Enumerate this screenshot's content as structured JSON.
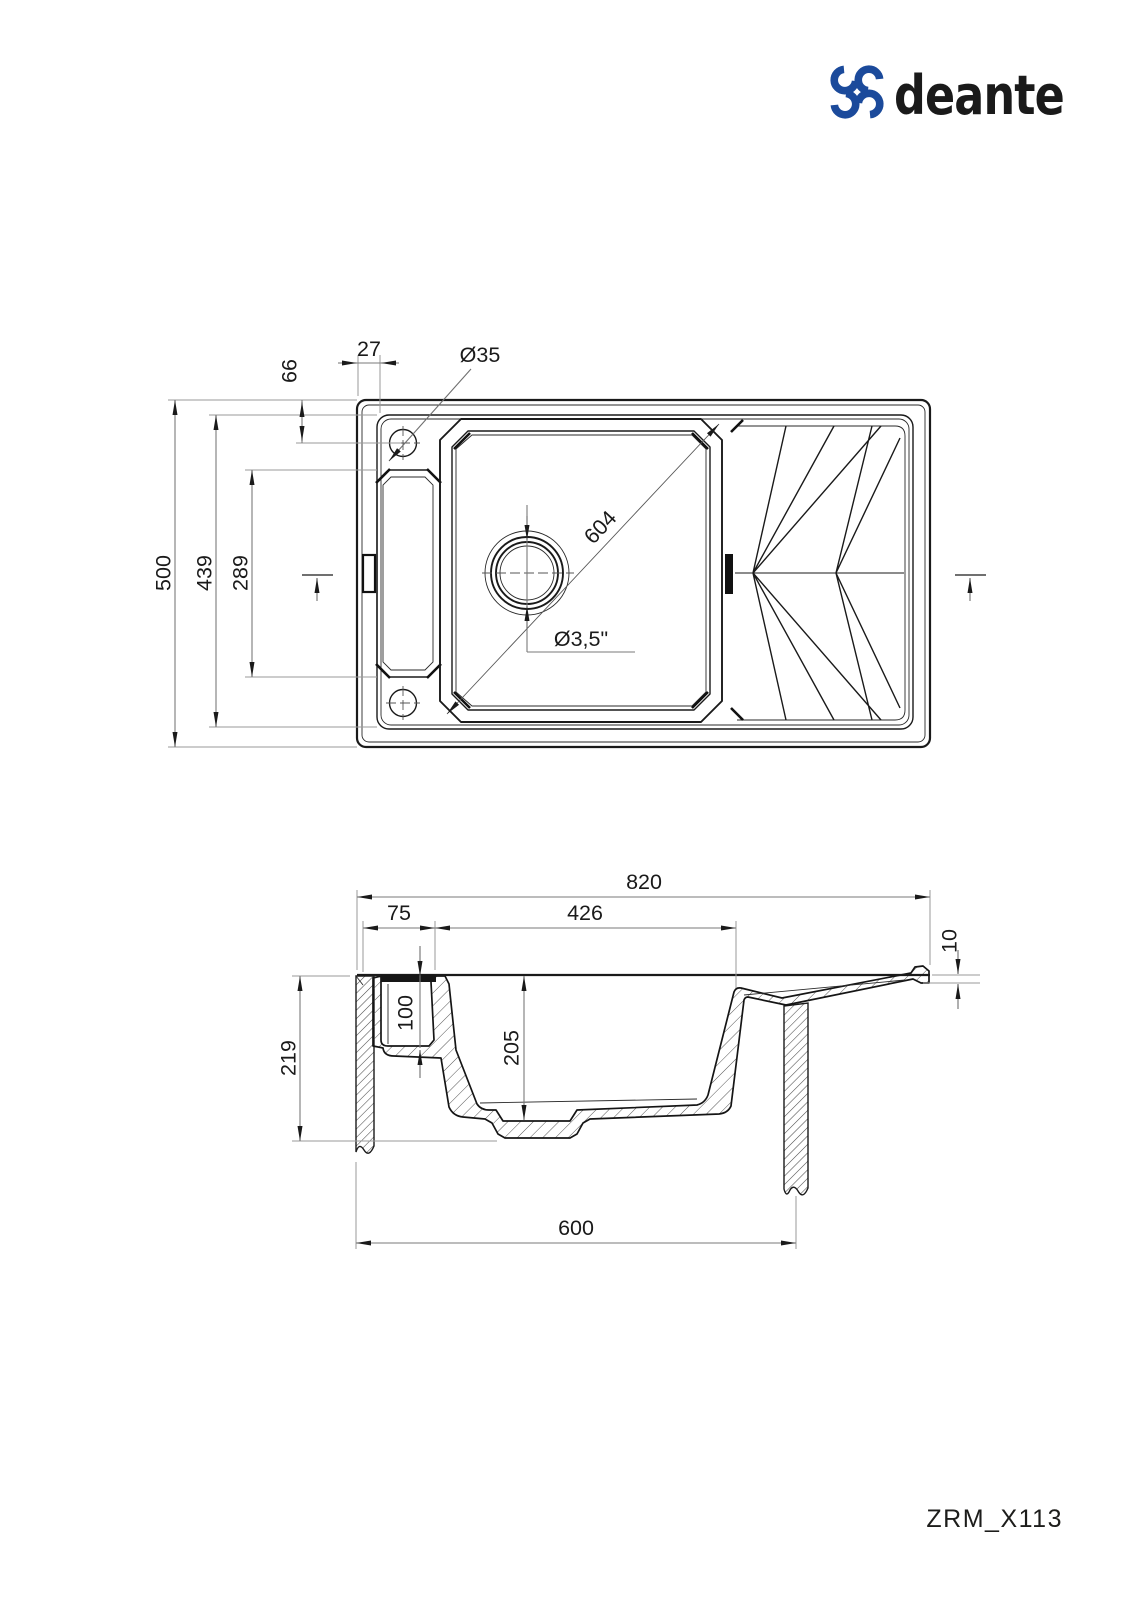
{
  "brand": {
    "name": "deante",
    "color": "#1B4A9B"
  },
  "model_code": "ZRM_X113",
  "top_view": {
    "description": "plan view of sink",
    "dims": {
      "overall_depth": "500",
      "inner_depth": "439",
      "recess_length": "289",
      "hole_offset_top": "66",
      "hole_offset_left": "27",
      "tap_hole_diameter": "Ø35",
      "bowl_diagonal": "604",
      "drain_diameter": "Ø3,5\""
    }
  },
  "side_view": {
    "description": "cross-section view of sink",
    "dims": {
      "overall_width": "820",
      "ledge_width": "75",
      "bowl_width": "426",
      "rim_thickness": "10",
      "total_depth": "219",
      "ledge_depth": "100",
      "bowl_depth": "205",
      "base_width": "600"
    }
  }
}
